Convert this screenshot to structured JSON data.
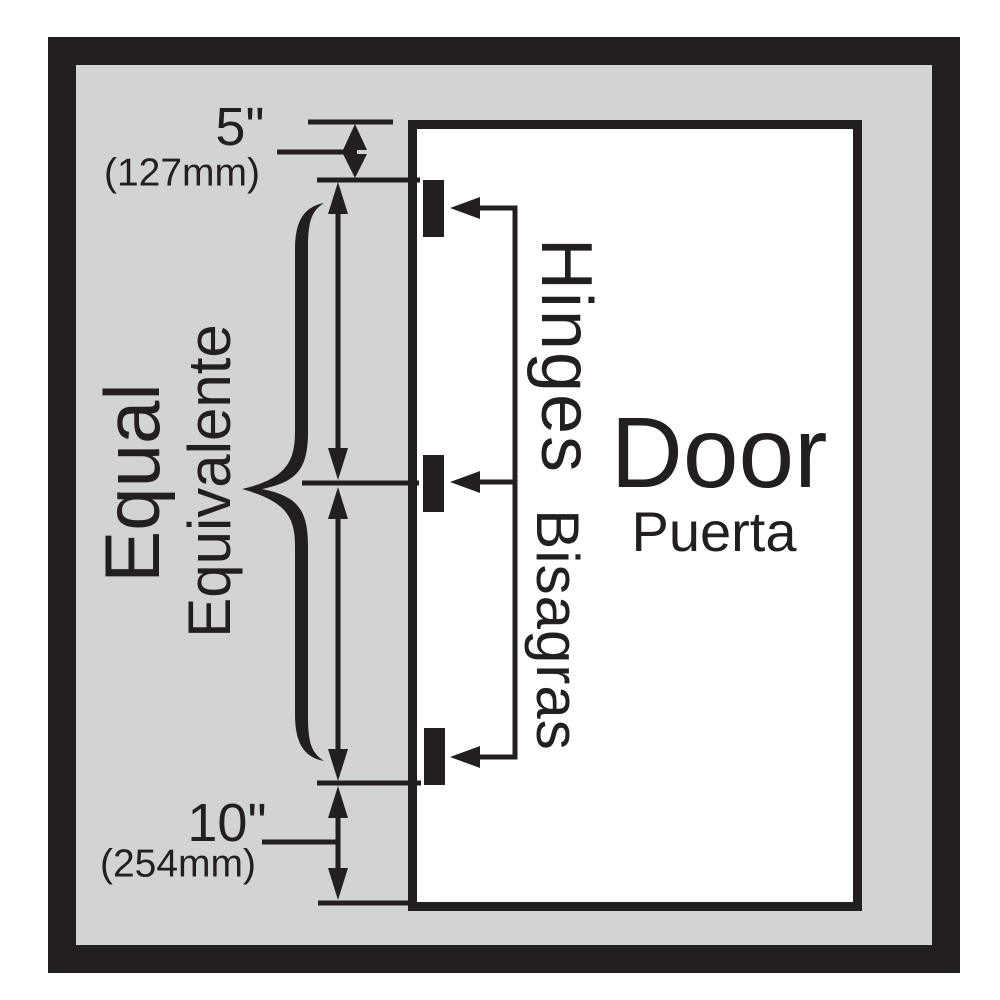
{
  "labels": {
    "top_inches": "5\"",
    "top_mm": "(127mm)",
    "bottom_inches": "10\"",
    "bottom_mm": "(254mm)",
    "equal_en": "Equal",
    "equal_es": "Equivalente",
    "hinges_en": "Hinges",
    "hinges_es": "Bisagras",
    "door_en": "Door",
    "door_es": "Puerta"
  },
  "colors": {
    "ink": "#231f20",
    "wall": "#d2d3d5",
    "paper": "#ffffff"
  }
}
